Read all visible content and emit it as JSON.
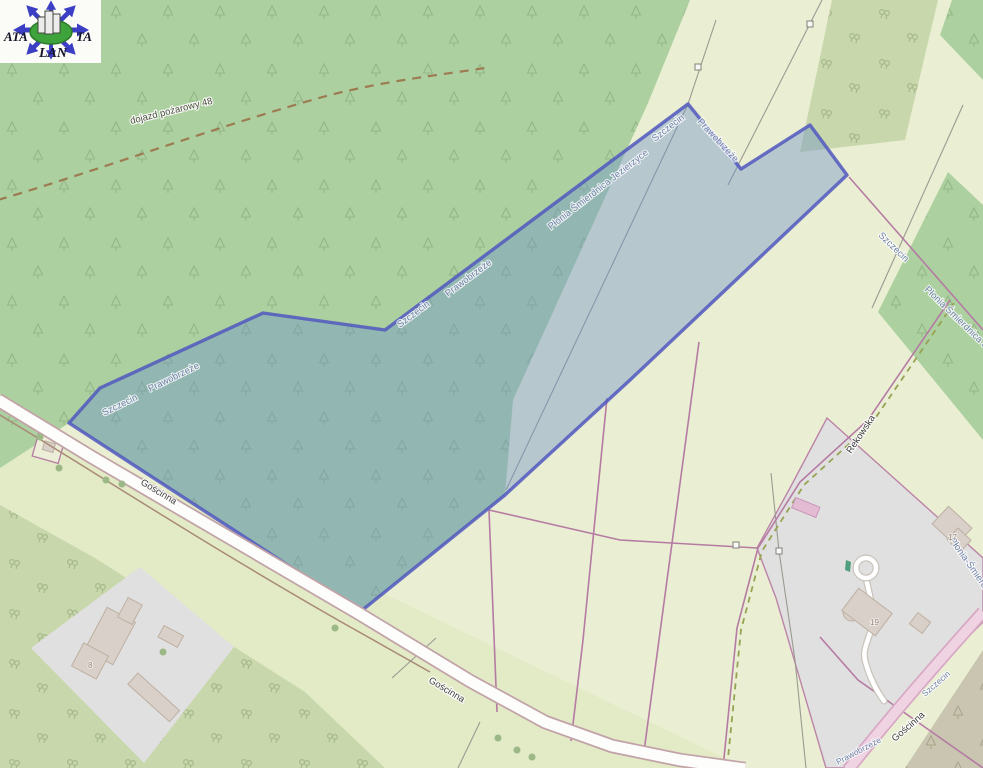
{
  "logo": {
    "text_left": "ATA",
    "text_right": "TA",
    "text_bottom": "LAN"
  },
  "labels": {
    "fire_road": "dojazd pożarowy 48",
    "szczecin": "Szczecin",
    "prawobrzeze": "Prawobrzeże",
    "plonia_full": "Płonia Śmierdnica Jezierzyce",
    "plonia_short": "Płonia Śmierdnica Jez",
    "plonia_hyph": "Płonia-Śmierdnica",
    "goscinna": "Gościnna",
    "rekowska": "Rekowska",
    "house_8": "8",
    "house_17": "17",
    "house_19": "19"
  },
  "colors": {
    "parcel_fill": "#6d92c9",
    "parcel_border": "#5158c0",
    "forest": "#acd0a0",
    "scrub": "#c9d8ac",
    "field": "#eaeed2",
    "meadow": "#e2eac6",
    "residential": "#e1e0e0",
    "boundary_line": "#b57ba3",
    "road_pink": "#efd3e3",
    "dark_grove": "#c9c5b0"
  }
}
